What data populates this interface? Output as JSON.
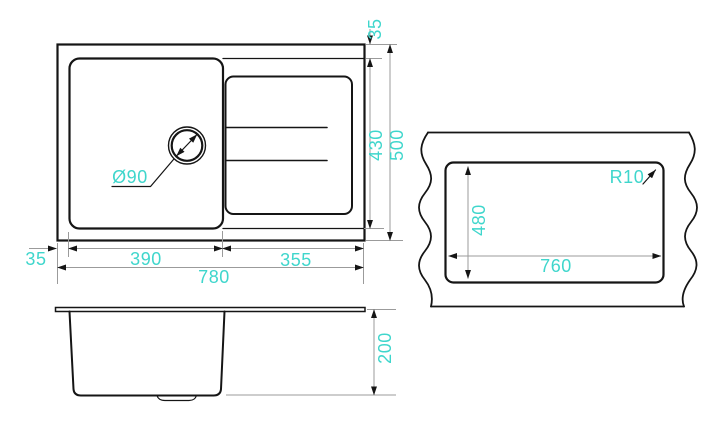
{
  "colors": {
    "line": "#151515",
    "dim_line": "#9b9b9b",
    "accent": "#3fd6cc",
    "background": "#ffffff"
  },
  "plan_view": {
    "drain_callout": "Ø90",
    "dim_top_rim": "35",
    "dim_bowl_length": "430",
    "dim_total_length": "500",
    "dim_left_rim": "35",
    "dim_bowl_width": "390",
    "dim_drainer_width": "355",
    "dim_total_width": "780"
  },
  "side_view": {
    "dim_depth": "200"
  },
  "cutout_view": {
    "dim_cutout_height": "480",
    "dim_cutout_width": "760",
    "dim_corner_radius": "R10"
  }
}
